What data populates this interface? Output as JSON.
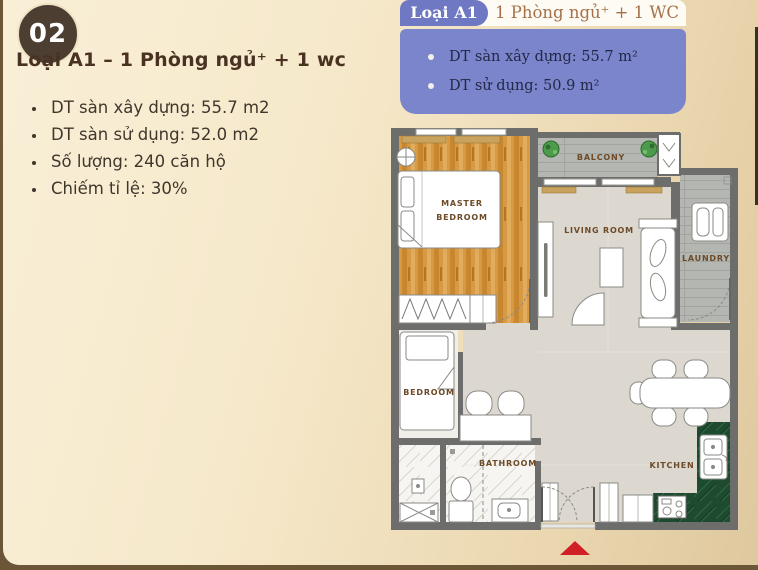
{
  "panel": {
    "badge": "02",
    "heading": "Loại A1 – 1 Phòng ngủ⁺ + 1 wc",
    "stats": [
      "DT sàn xây dựng: 55.7 m2",
      "DT sàn sử dụng: 52.0 m2",
      "Số lượng: 240 căn hộ",
      "Chiếm tỉ lệ: 30%"
    ]
  },
  "info_box": {
    "tag": "Loại A1",
    "title": "1 Phòng ngủ⁺ + 1 WC",
    "items": [
      "DT sàn xây dựng: 55.7 m²",
      "DT sử dụng: 50.9 m²"
    ]
  },
  "floorplan": {
    "labels": {
      "master_line1": "MASTER",
      "master_line2": "BEDROOM",
      "balcony": "BALCONY",
      "living_room": "LIVING ROOM",
      "laundry": "LAUNDRY",
      "bedroom": "BEDROOM",
      "bathroom": "BATHROOM",
      "kitchen": "KITCHEN"
    }
  },
  "colors": {
    "accent_purple": "#7b85cb",
    "tag_purple": "#6f78c2",
    "badge_brown": "#4c3e31",
    "heading_brown": "#4a3222",
    "info_title_brown": "#a5714a",
    "wall_gray": "#6d6e6c",
    "wood_floor": "#d69944",
    "balcony_gray": "#b3b6b1",
    "living_floor": "#dcd8cf",
    "kitchen_green": "#1e4a30",
    "entrance_marker_red": "#d11f26",
    "background_cream": "#f8eed4",
    "frame_brown": "#6b5637"
  }
}
